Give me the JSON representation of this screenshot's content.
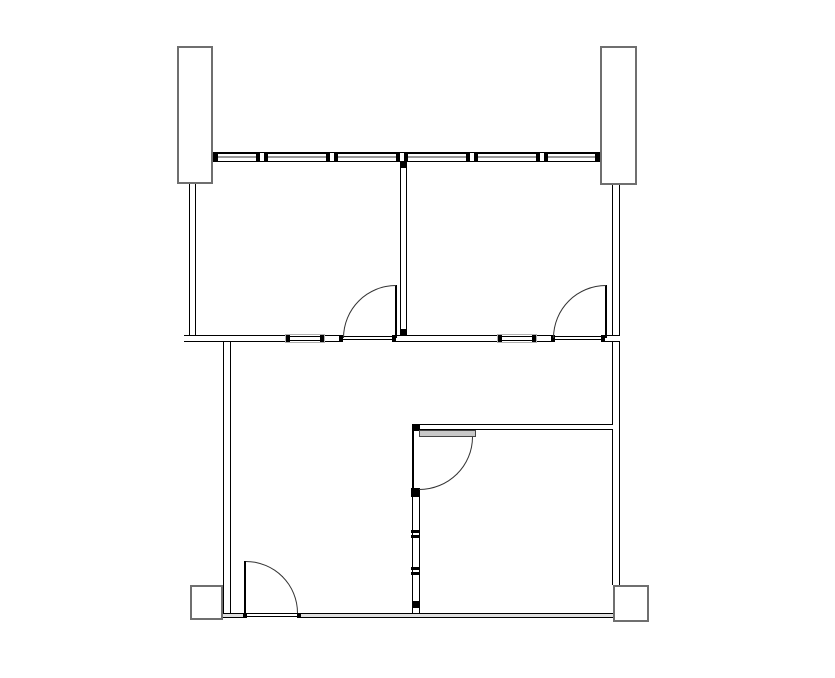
{
  "meta": {
    "drawing_type": "architectural-floor-plan",
    "visible_text": []
  },
  "canvas": {
    "width": 835,
    "height": 678,
    "background": "#ffffff"
  },
  "colors": {
    "line": "#000000",
    "arc_line": "#333333",
    "column_border": "#6f6f6f",
    "glazing": "#999999",
    "wall_fill": "#ffffff",
    "bottom_wall_fill": "#e0e0e0",
    "leaf_fill": "#c9c9c9",
    "leaf_border": "#444444",
    "iwin_border": "#b0b0b0"
  },
  "elements": [
    {
      "t": "col",
      "name": "column-top-left",
      "x": 177,
      "y": 46,
      "w": 36,
      "h": 138
    },
    {
      "t": "col",
      "name": "column-top-right",
      "x": 600,
      "y": 46,
      "w": 37,
      "h": 139
    },
    {
      "t": "col",
      "name": "column-bottom-left",
      "x": 190,
      "y": 585,
      "w": 33,
      "h": 35
    },
    {
      "t": "col",
      "name": "column-bottom-right",
      "x": 613,
      "y": 585,
      "w": 36,
      "h": 37
    },
    {
      "t": "band",
      "name": "window-band-north",
      "x": 213,
      "y": 152,
      "w": 387,
      "h": 10,
      "capw": 5,
      "caps": [
        0,
        382
      ],
      "mullions": [
        43,
        113,
        183,
        253,
        323
      ]
    },
    {
      "t": "vwall",
      "name": "wall-left-upper",
      "x": 189,
      "y": 184,
      "w": 7,
      "h": 151
    },
    {
      "t": "vwall",
      "name": "wall-left-lower",
      "x": 223,
      "y": 342,
      "w": 8,
      "h": 276
    },
    {
      "t": "vwall",
      "name": "wall-right",
      "x": 612,
      "y": 185,
      "w": 8,
      "h": 400
    },
    {
      "t": "vwall",
      "name": "wall-upper-divider",
      "x": 400,
      "y": 162,
      "w": 7,
      "h": 173
    },
    {
      "t": "hwall",
      "name": "wall-middle-seg-1",
      "x": 184,
      "y": 335,
      "w": 101,
      "h": 7
    },
    {
      "t": "hwall",
      "name": "wall-middle-seg-2",
      "x": 325,
      "y": 335,
      "w": 18,
      "h": 7
    },
    {
      "t": "hwall",
      "name": "wall-middle-seg-3",
      "x": 396,
      "y": 335,
      "w": 101,
      "h": 7
    },
    {
      "t": "hwall",
      "name": "wall-middle-seg-4",
      "x": 537,
      "y": 335,
      "w": 18,
      "h": 7
    },
    {
      "t": "hwall",
      "name": "wall-middle-seg-5",
      "x": 605,
      "y": 335,
      "w": 15,
      "h": 7
    },
    {
      "t": "hwall",
      "name": "wall-interior-lower-right",
      "x": 412,
      "y": 424,
      "w": 201,
      "h": 6
    },
    {
      "t": "bwall",
      "name": "wall-bottom-seg-1",
      "x": 223,
      "y": 613,
      "w": 24,
      "h": 5
    },
    {
      "t": "bwall",
      "name": "wall-bottom-seg-2",
      "x": 297,
      "y": 613,
      "w": 316,
      "h": 5
    },
    {
      "t": "thresh",
      "name": "threshold-door-upper-left",
      "x": 343,
      "y": 336,
      "w": 53,
      "h": 4
    },
    {
      "t": "thresh",
      "name": "threshold-door-upper-right",
      "x": 555,
      "y": 336,
      "w": 50,
      "h": 4
    },
    {
      "t": "thresh",
      "name": "threshold-door-lower-left",
      "x": 247,
      "y": 613,
      "w": 50,
      "h": 4
    },
    {
      "t": "iwin",
      "name": "interior-window-left",
      "x": 285,
      "y": 334,
      "w": 40,
      "h": 9
    },
    {
      "t": "iwin",
      "name": "interior-window-right",
      "x": 497,
      "y": 334,
      "w": 40,
      "h": 9
    },
    {
      "t": "block",
      "name": "divider-top-cap",
      "x": 400,
      "y": 162,
      "w": 7,
      "h": 6
    },
    {
      "t": "block",
      "name": "divider-bottom-cap",
      "x": 400,
      "y": 329,
      "w": 7,
      "h": 6
    },
    {
      "t": "block",
      "name": "jamb-upper-left-door-a",
      "x": 339,
      "y": 335,
      "w": 4,
      "h": 7
    },
    {
      "t": "block",
      "name": "jamb-upper-left-door-b",
      "x": 392,
      "y": 335,
      "w": 4,
      "h": 7
    },
    {
      "t": "block",
      "name": "jamb-upper-right-door-a",
      "x": 551,
      "y": 335,
      "w": 4,
      "h": 7
    },
    {
      "t": "block",
      "name": "jamb-upper-right-door-b",
      "x": 601,
      "y": 335,
      "w": 4,
      "h": 7
    },
    {
      "t": "block",
      "name": "jamb-lower-left-door-a",
      "x": 243,
      "y": 613,
      "w": 4,
      "h": 5
    },
    {
      "t": "block",
      "name": "jamb-lower-left-door-b",
      "x": 297,
      "y": 613,
      "w": 4,
      "h": 5
    },
    {
      "t": "block",
      "name": "partition-top-cap",
      "x": 412,
      "y": 424,
      "w": 8,
      "h": 7
    },
    {
      "t": "line",
      "name": "partition-door-face-line",
      "x": 412,
      "y": 431,
      "w": 1.5,
      "h": 57
    },
    {
      "t": "block",
      "name": "partition-jamb-block",
      "x": 411,
      "y": 488,
      "w": 9,
      "h": 9
    },
    {
      "t": "vwall",
      "name": "partition-lower",
      "x": 412,
      "y": 497,
      "w": 8,
      "h": 116
    },
    {
      "t": "block",
      "name": "partition-tick-1a",
      "x": 411,
      "y": 530,
      "w": 9,
      "h": 3
    },
    {
      "t": "block",
      "name": "partition-tick-1b",
      "x": 411,
      "y": 535,
      "w": 9,
      "h": 3
    },
    {
      "t": "block",
      "name": "partition-tick-2a",
      "x": 411,
      "y": 567,
      "w": 9,
      "h": 3
    },
    {
      "t": "block",
      "name": "partition-tick-2b",
      "x": 411,
      "y": 572,
      "w": 9,
      "h": 3
    },
    {
      "t": "block",
      "name": "partition-bottom-cap",
      "x": 412,
      "y": 601,
      "w": 8,
      "h": 7
    },
    {
      "t": "leafv",
      "name": "door-upper-left-leaf",
      "x": 395,
      "y": 285,
      "w": 1.5,
      "h": 53
    },
    {
      "t": "arc",
      "name": "door-upper-left-arc",
      "x": 343,
      "y": 285,
      "w": 53,
      "h": 53,
      "corner": "tl"
    },
    {
      "t": "leafv",
      "name": "door-upper-right-leaf",
      "x": 605,
      "y": 285,
      "w": 1.5,
      "h": 53
    },
    {
      "t": "arc",
      "name": "door-upper-right-arc",
      "x": 553,
      "y": 285,
      "w": 53,
      "h": 53,
      "corner": "tl"
    },
    {
      "t": "leafv",
      "name": "door-lower-left-leaf",
      "x": 244,
      "y": 561,
      "w": 1.5,
      "h": 52
    },
    {
      "t": "arc",
      "name": "door-lower-left-arc",
      "x": 246,
      "y": 561,
      "w": 52,
      "h": 52,
      "corner": "tr"
    },
    {
      "t": "leafh",
      "name": "door-lower-right-leaf",
      "x": 419,
      "y": 430,
      "w": 57,
      "h": 7
    },
    {
      "t": "arc",
      "name": "door-lower-right-arc",
      "x": 419,
      "y": 437,
      "w": 54,
      "h": 53,
      "corner": "br"
    }
  ]
}
